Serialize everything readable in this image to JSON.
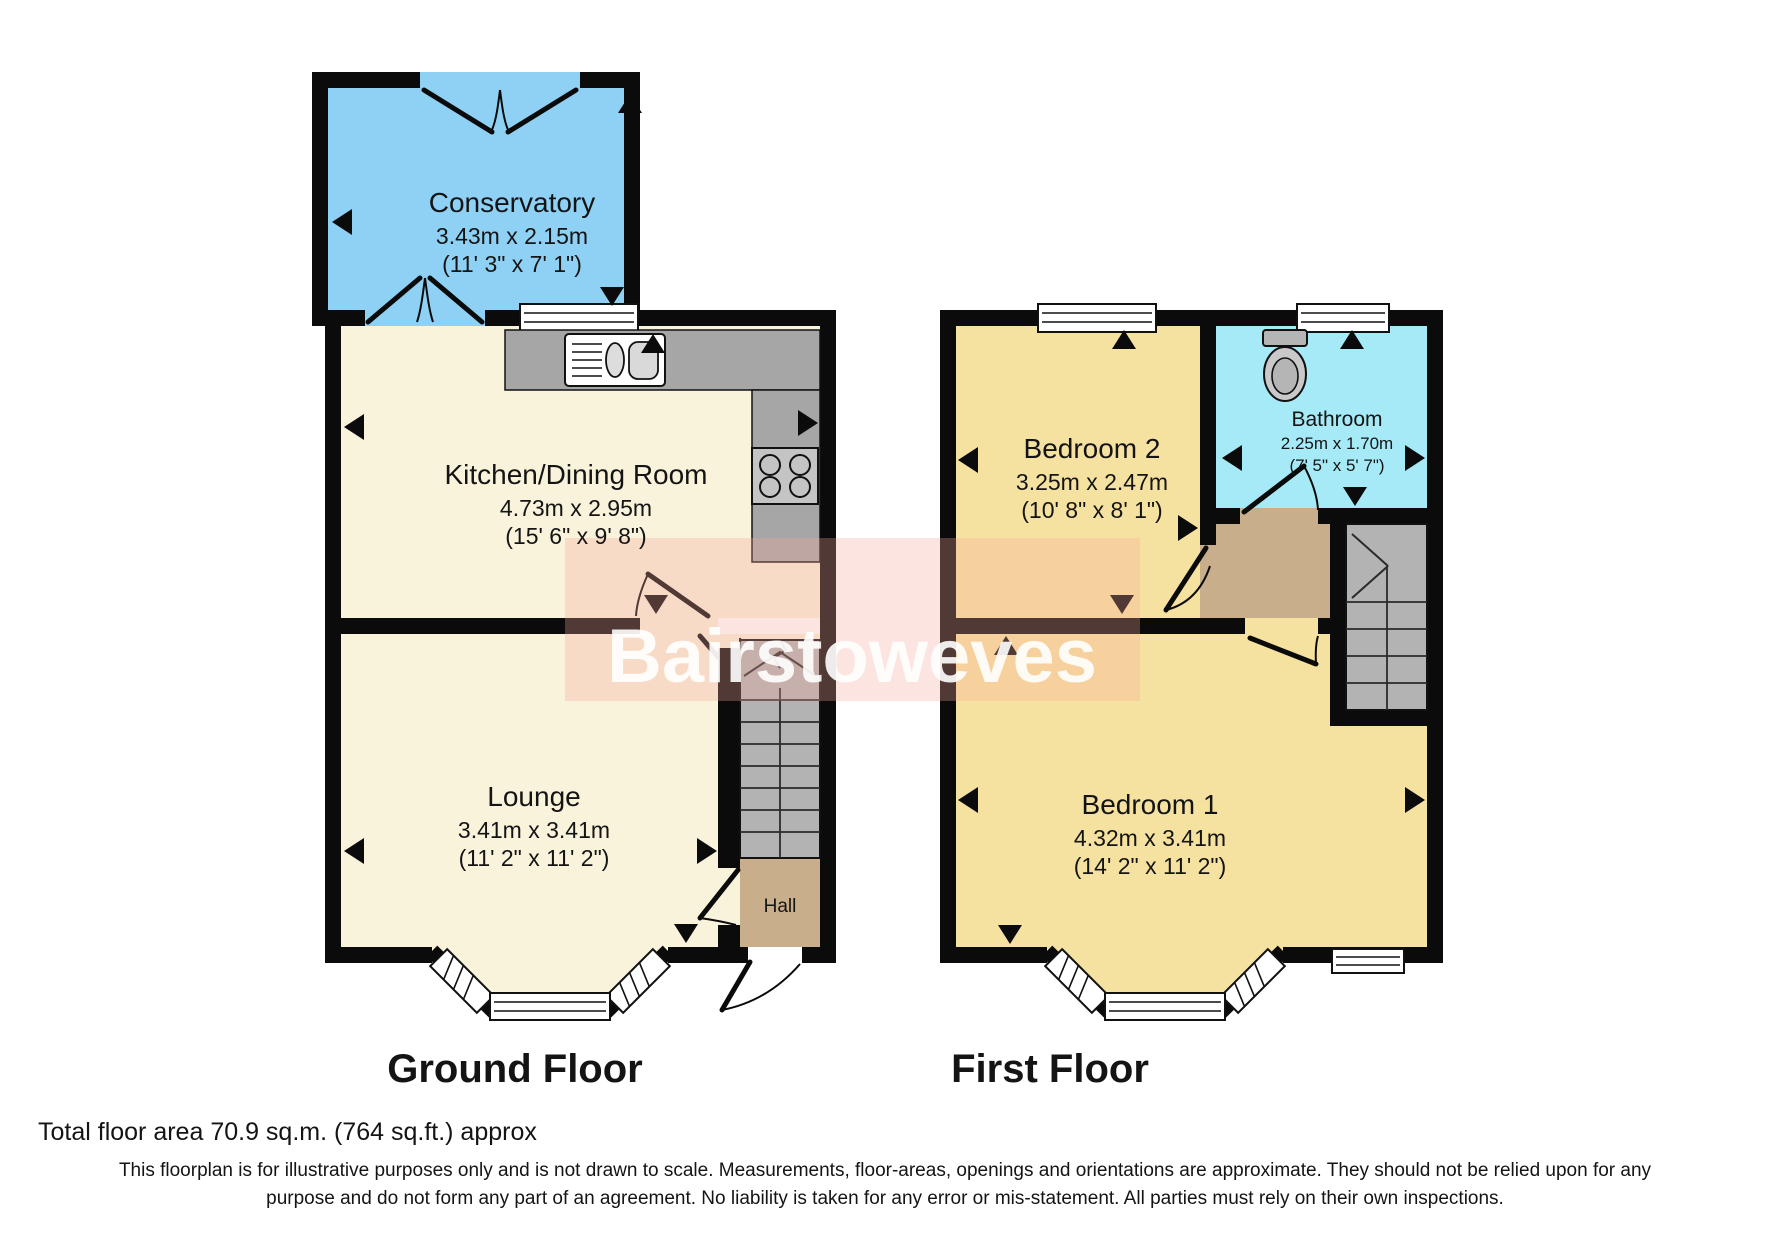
{
  "watermark": {
    "text": "Bairstoweves"
  },
  "ground_floor": {
    "label": "Ground Floor",
    "rooms": {
      "conservatory": {
        "name": "Conservatory",
        "metric": "3.43m x 2.15m",
        "imperial": "(11' 3\" x 7' 1\")"
      },
      "kitchen": {
        "name": "Kitchen/Dining Room",
        "metric": "4.73m x 2.95m",
        "imperial": "(15' 6\" x 9' 8\")"
      },
      "lounge": {
        "name": "Lounge",
        "metric": "3.41m x 3.41m",
        "imperial": "(11' 2\" x 11' 2\")"
      },
      "hall": {
        "name": "Hall"
      }
    }
  },
  "first_floor": {
    "label": "First Floor",
    "rooms": {
      "bedroom2": {
        "name": "Bedroom 2",
        "metric": "3.25m x 2.47m",
        "imperial": "(10' 8\" x 8' 1\")"
      },
      "bathroom": {
        "name": "Bathroom",
        "metric": "2.25m x 1.70m",
        "imperial": "(7' 5\" x 5' 7\")"
      },
      "bedroom1": {
        "name": "Bedroom 1",
        "metric": "4.32m x 3.41m",
        "imperial": "(14' 2\" x 11' 2\")"
      }
    }
  },
  "footer": {
    "total_area": "Total floor area 70.9 sq.m. (764 sq.ft.) approx",
    "disclaimer_line1": "This floorplan is for illustrative purposes only and is not drawn to scale. Measurements, floor-areas, openings and orientations are approximate. They should not be relied upon for any",
    "disclaimer_line2": "purpose and do not form any part of an agreement. No liability is taken for any error or mis-statement. All parties must rely on their own inspections."
  },
  "colors": {
    "wall": "#0b0b0b",
    "conservatory": "#8FD1F4",
    "cream_room": "#FAF3DC",
    "bedroom_yellow": "#F6E2A0",
    "bathroom_cyan": "#A5EAF6",
    "hall_tan": "#C9AE8B",
    "stairs_gray": "#B3B3B3",
    "counter_gray": "#A6A6A6",
    "watermark_pink": "#F6A497"
  }
}
